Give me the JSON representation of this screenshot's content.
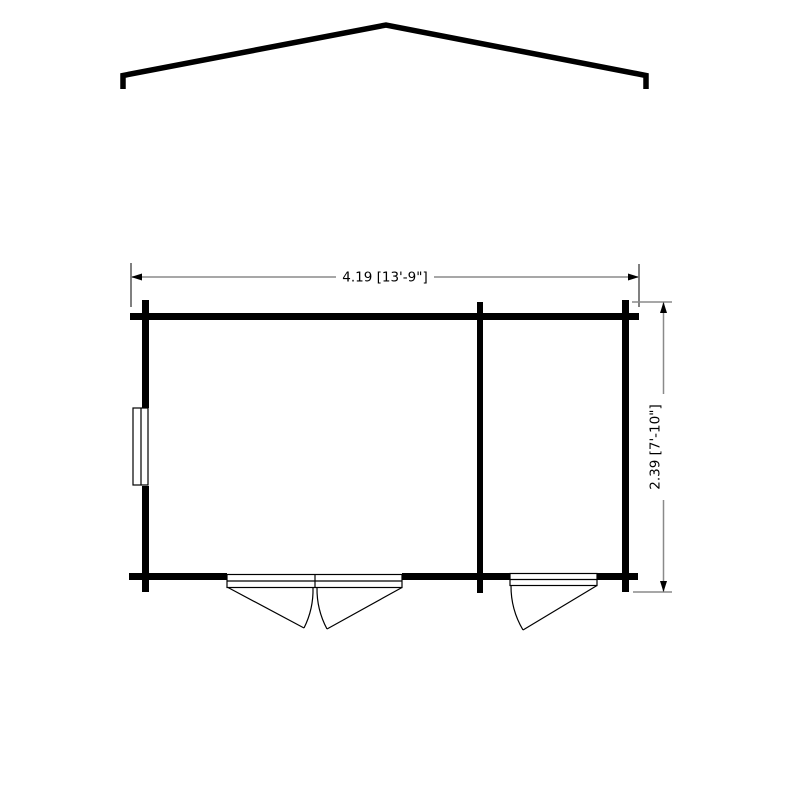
{
  "drawing": {
    "kind": "garden-building-floor-plan",
    "views": [
      "roof-apex-profile",
      "floor-plan"
    ],
    "room_count": 2,
    "openings": {
      "double_door_count": 1,
      "single_door_count": 1,
      "window_count": 1
    }
  },
  "dimensions": {
    "width": {
      "label": "4.19 [13'-9\"]",
      "meters": "4.19",
      "feet_inches": "13'-9\""
    },
    "depth": {
      "label": "2.39 [7'-10\"]",
      "meters": "2.39",
      "feet_inches": "7'-10\""
    }
  },
  "colors": {
    "background": "#ffffff",
    "line": "#000000",
    "dimension_line": "#8a8a8a"
  }
}
